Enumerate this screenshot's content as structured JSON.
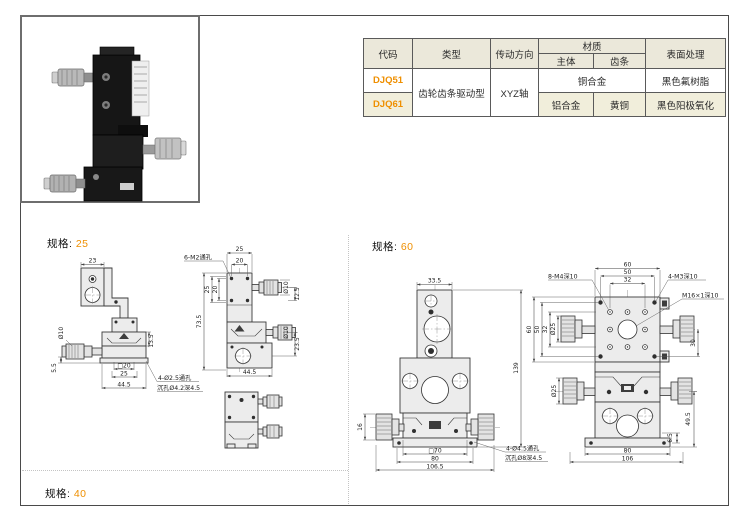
{
  "colors": {
    "accent": "#ef8f00",
    "table_header_bg": "#ebe8da",
    "table_alt_bg": "#f1eedb"
  },
  "table": {
    "headers": {
      "code": "代码",
      "type": "类型",
      "direction": "传动方向",
      "material": "材质",
      "body": "主体",
      "rack": "齿条",
      "surface": "表面处理"
    },
    "rows": {
      "r1": {
        "code": "DJQ51",
        "type": "齿轮齿条驱动型",
        "direction": "XYZ轴",
        "material_both": "铜合金",
        "surface": "黑色氟树脂"
      },
      "r2": {
        "code": "DJQ61",
        "body": "铝合金",
        "rack": "黄铜",
        "surface": "黑色阳极氧化"
      }
    }
  },
  "sections": {
    "spec25": {
      "label": "规格:",
      "value": "25"
    },
    "spec60": {
      "label": "规格:",
      "value": "60"
    },
    "spec40": {
      "label": "规格:",
      "value": "40"
    }
  },
  "dims": {
    "s25_side": {
      "w23": "23",
      "d10": "Ø10",
      "h13_5": "13.5",
      "h5_5": "5.5",
      "sq20": "□20",
      "w25": "25",
      "w44_5": "44.5",
      "note1": "4-Ø2.5通孔",
      "note2": "沉孔Ø4.2深4.5"
    },
    "s25_front": {
      "note_m2": "6-M2通孔",
      "t25": "25",
      "t20": "20",
      "l73_5": "73.5",
      "l25": "25",
      "l20": "20",
      "r_d10a": "Ø10",
      "r12_5": "12.5",
      "r_d10b": "Ø10",
      "r23_5": "23.5",
      "b44_5": "44.5"
    },
    "s60_front": {
      "t33_5": "33.5",
      "r139": "139",
      "l16": "16",
      "b_sq70": "□70",
      "b80": "80",
      "b106_5": "106.5",
      "note1": "4-Ø4.5通孔",
      "note2": "沉孔Ø8深4.5"
    },
    "s60_top": {
      "t60": "60",
      "t50": "50",
      "t32": "32",
      "note_m4": "8-M4深10",
      "note_m3": "4-M3深10",
      "note_m16": "M16×1深10",
      "l60": "60",
      "l50": "50",
      "l32": "32",
      "d25u": "Ø25",
      "d25l": "Ø25",
      "r30": "30",
      "r6_5": "6.5",
      "r49_5": "49.5",
      "b80": "80",
      "b106": "106"
    }
  }
}
